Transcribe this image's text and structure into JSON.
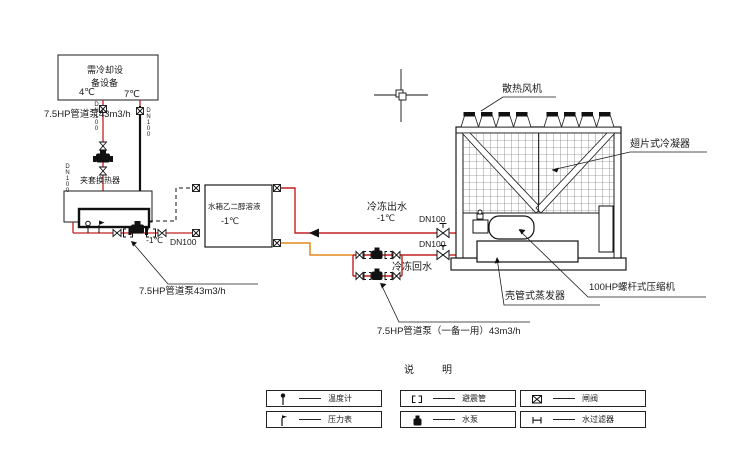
{
  "diagram": {
    "equipment_box": {
      "line1": "需冷却设",
      "line2": "备设备"
    },
    "temperatures": {
      "supply": "4℃",
      "return": "7℃"
    },
    "pipe_labels": {
      "pump_top": "7.5HP管道泵43m3/h",
      "pump_left": "7.5HP管道泵43m3/h",
      "pump_duty_standby": "7.5HP管道泵（一备一用）43m3/h",
      "dn100_vertical_left": "DN100",
      "dn100_vertical_right": "DN100",
      "dn100_vertical_riser": "DN100",
      "main_temp": "-1℃",
      "main_dn": "DN100",
      "chilled_out": "冷冻出水",
      "chilled_out_temp": "-1℃",
      "chilled_out_dn": "DN100",
      "chilled_return_dn": "DN100",
      "chilled_return": "冷冻回水"
    },
    "heat_exchanger_label": "夹套换热器",
    "tank": {
      "line1": "水箱乙二醇溶液",
      "line2": "-1℃"
    },
    "chiller_labels": {
      "fan": "散热风机",
      "condenser": "翅片式冷凝器",
      "evaporator": "壳管式蒸发器",
      "compressor": "100HP螺杆式压缩机"
    },
    "legend": {
      "title": "说　明",
      "items": [
        {
          "symbol": "thermometer",
          "label": "温度计"
        },
        {
          "symbol": "flex-pipe",
          "label": "避震管"
        },
        {
          "symbol": "gate-valve",
          "label": "闸阀"
        },
        {
          "symbol": "pressure-gauge",
          "label": "压力表"
        },
        {
          "symbol": "pump",
          "label": "水泵"
        },
        {
          "symbol": "strainer",
          "label": "水过滤器"
        }
      ]
    },
    "colors": {
      "pipe_red": "#c22121",
      "pipe_orange": "#e2881e",
      "line_black": "#1b1b1b"
    }
  }
}
